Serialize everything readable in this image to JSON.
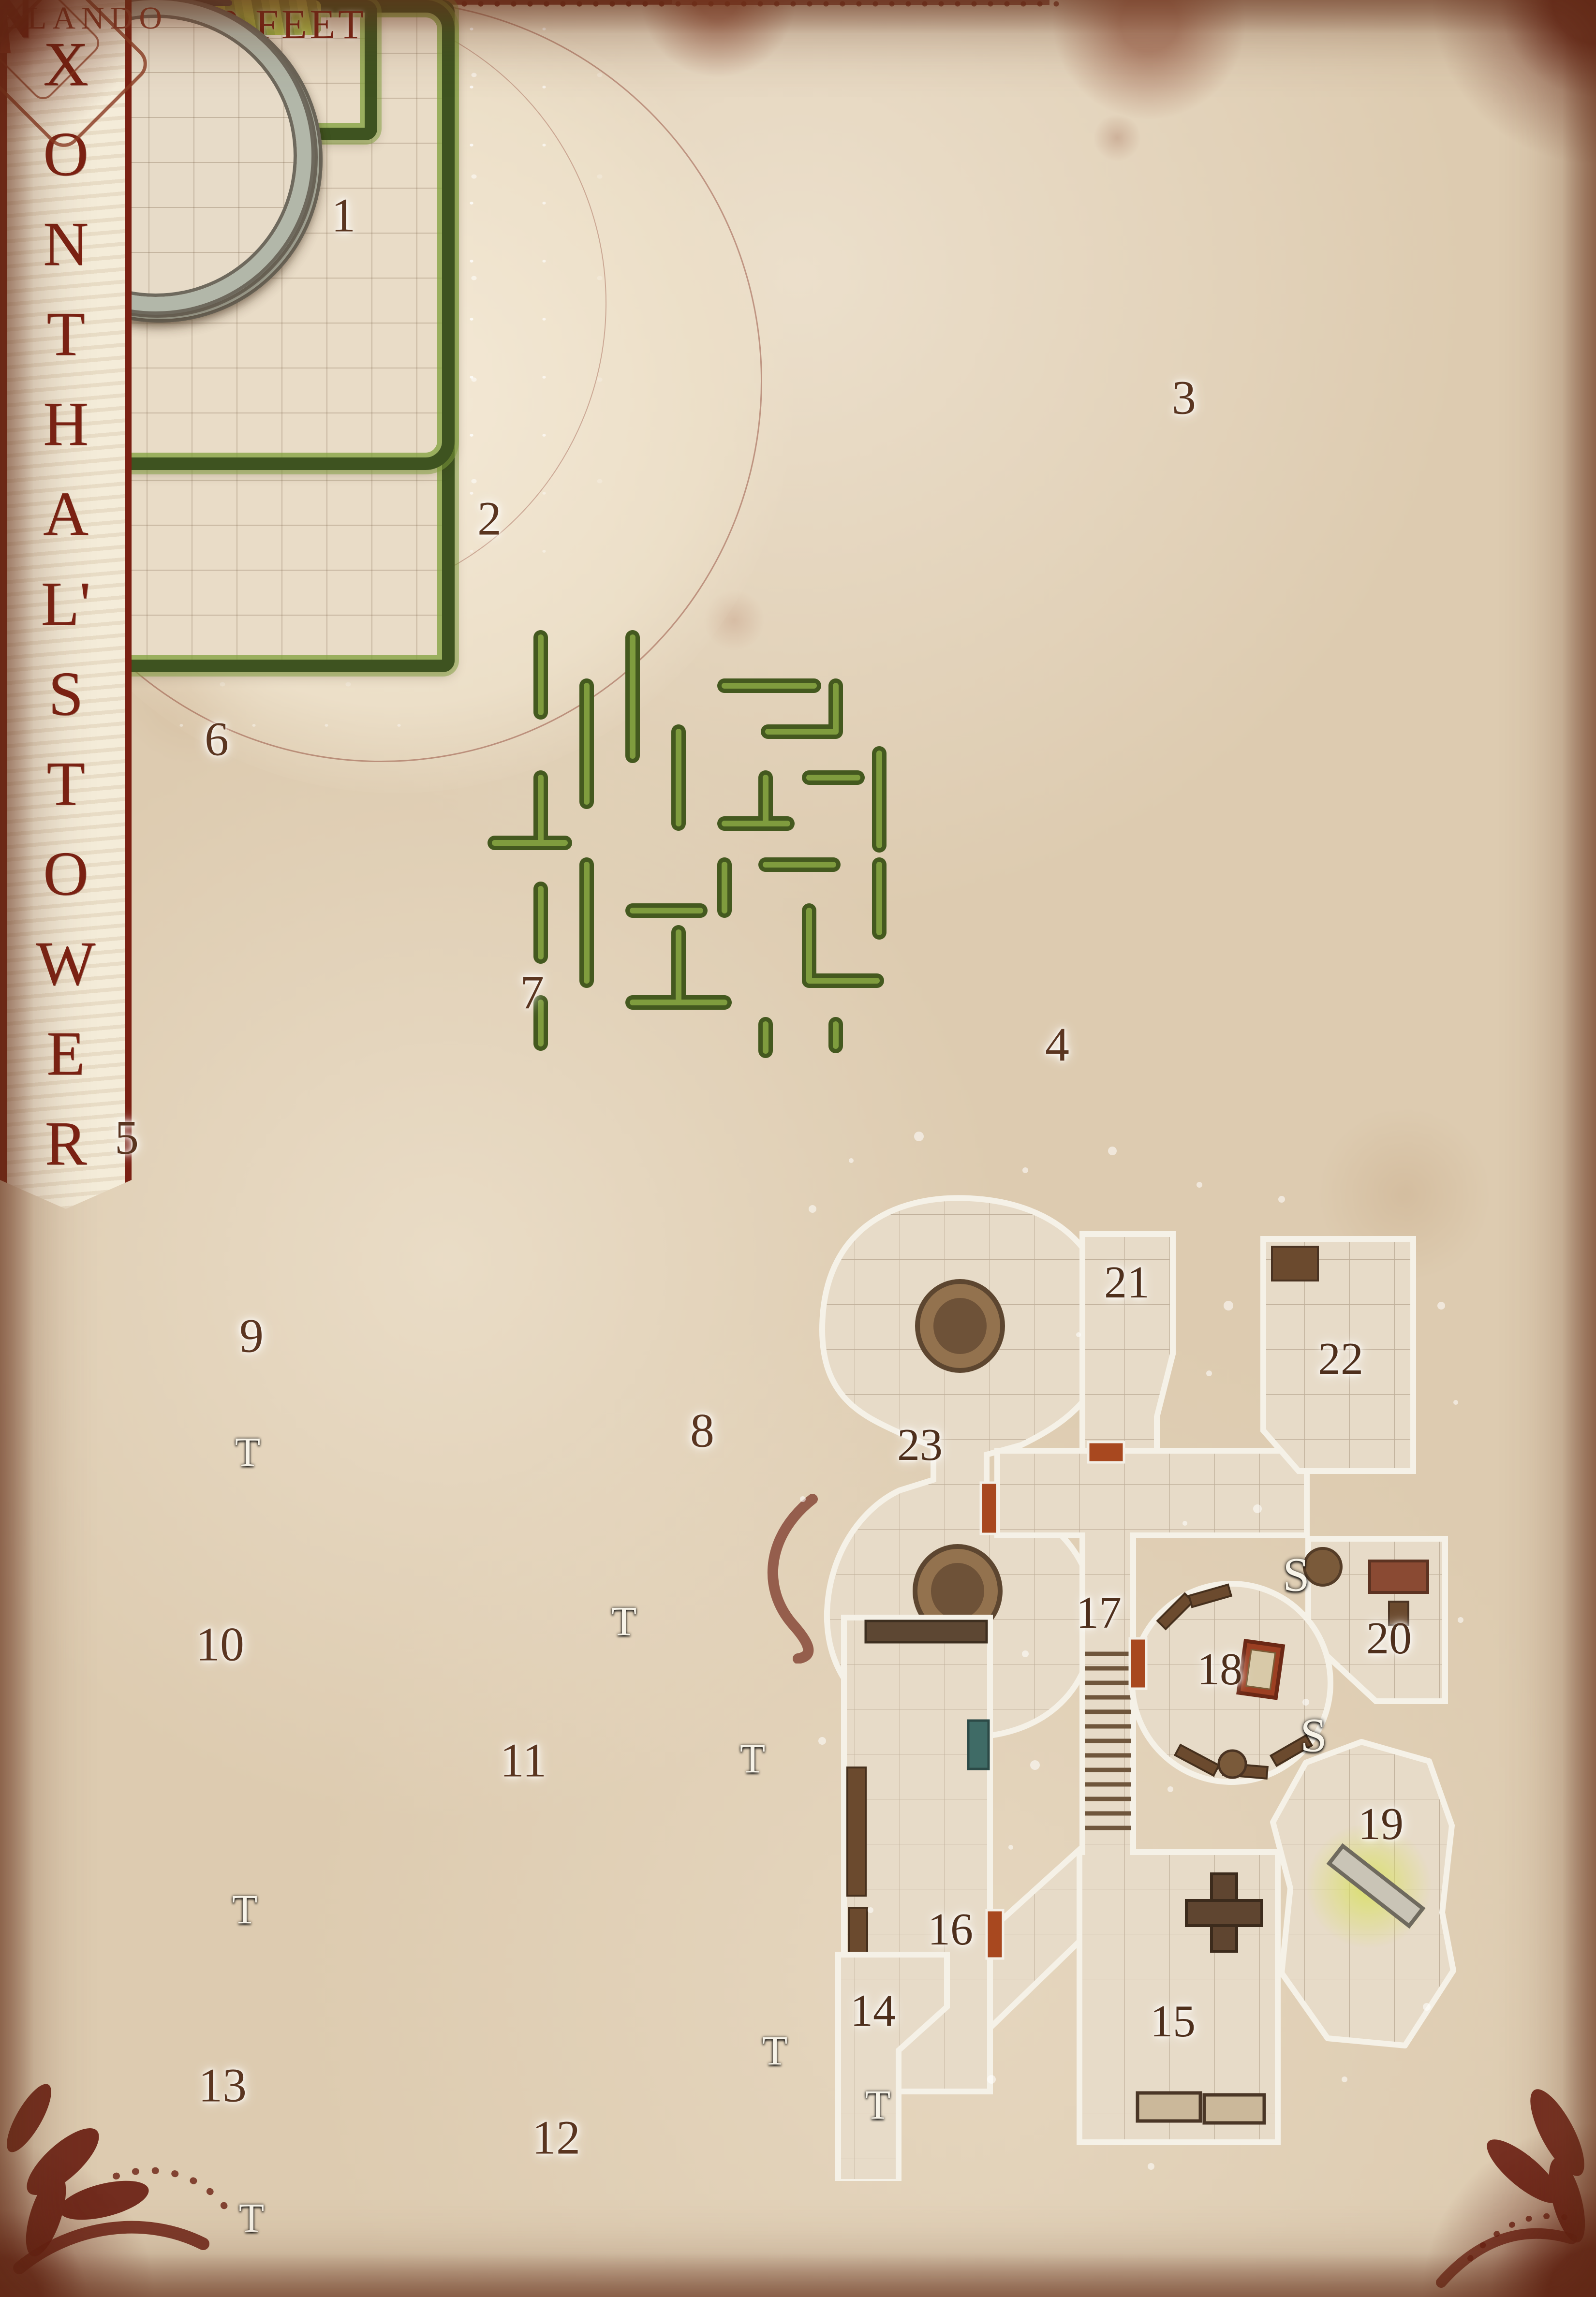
{
  "title": {
    "text": "XONTHAL'S TOWER",
    "letters": [
      "X",
      "O",
      "N",
      "T",
      "H",
      "A",
      "L'",
      "S",
      "T",
      "O",
      "W",
      "E",
      "R"
    ]
  },
  "legend": {
    "square_label": "EQUALS 10 FEET"
  },
  "credit": {
    "artist": "BLANDO"
  },
  "compass": {
    "north": "N"
  },
  "markers": {
    "teleport": "T",
    "secret": "S"
  },
  "map": {
    "garden_areas": [
      {
        "num": "1",
        "letters": [
          "H",
          "A",
          "B",
          "G",
          "C",
          "F",
          "E",
          "D"
        ]
      },
      {
        "num": "2"
      },
      {
        "num": "3"
      },
      {
        "num": "4"
      },
      {
        "num": "5"
      },
      {
        "num": "6"
      },
      {
        "num": "7"
      }
    ],
    "tower_rooms": [
      {
        "num": "8"
      },
      {
        "num": "9"
      },
      {
        "num": "10"
      },
      {
        "num": "11"
      },
      {
        "num": "12"
      },
      {
        "num": "13"
      }
    ],
    "dungeon_rooms": [
      {
        "num": "14"
      },
      {
        "num": "15"
      },
      {
        "num": "16"
      },
      {
        "num": "17"
      },
      {
        "num": "18"
      },
      {
        "num": "19"
      },
      {
        "num": "20"
      },
      {
        "num": "21"
      },
      {
        "num": "22"
      },
      {
        "num": "23"
      }
    ]
  },
  "colors": {
    "accent_red": "#7a2013",
    "arrow_red": "#a64530",
    "hedge_green_dark": "#3e5320",
    "hedge_green_light": "#7fa03b",
    "pool_teal": "#2a5561",
    "carpet_red": "#8e2317",
    "parchment": "#e3d2b9",
    "dungeon_dark": "#33291f",
    "floor_tan": "#e7dbc8",
    "door_red": "#a8481f"
  }
}
